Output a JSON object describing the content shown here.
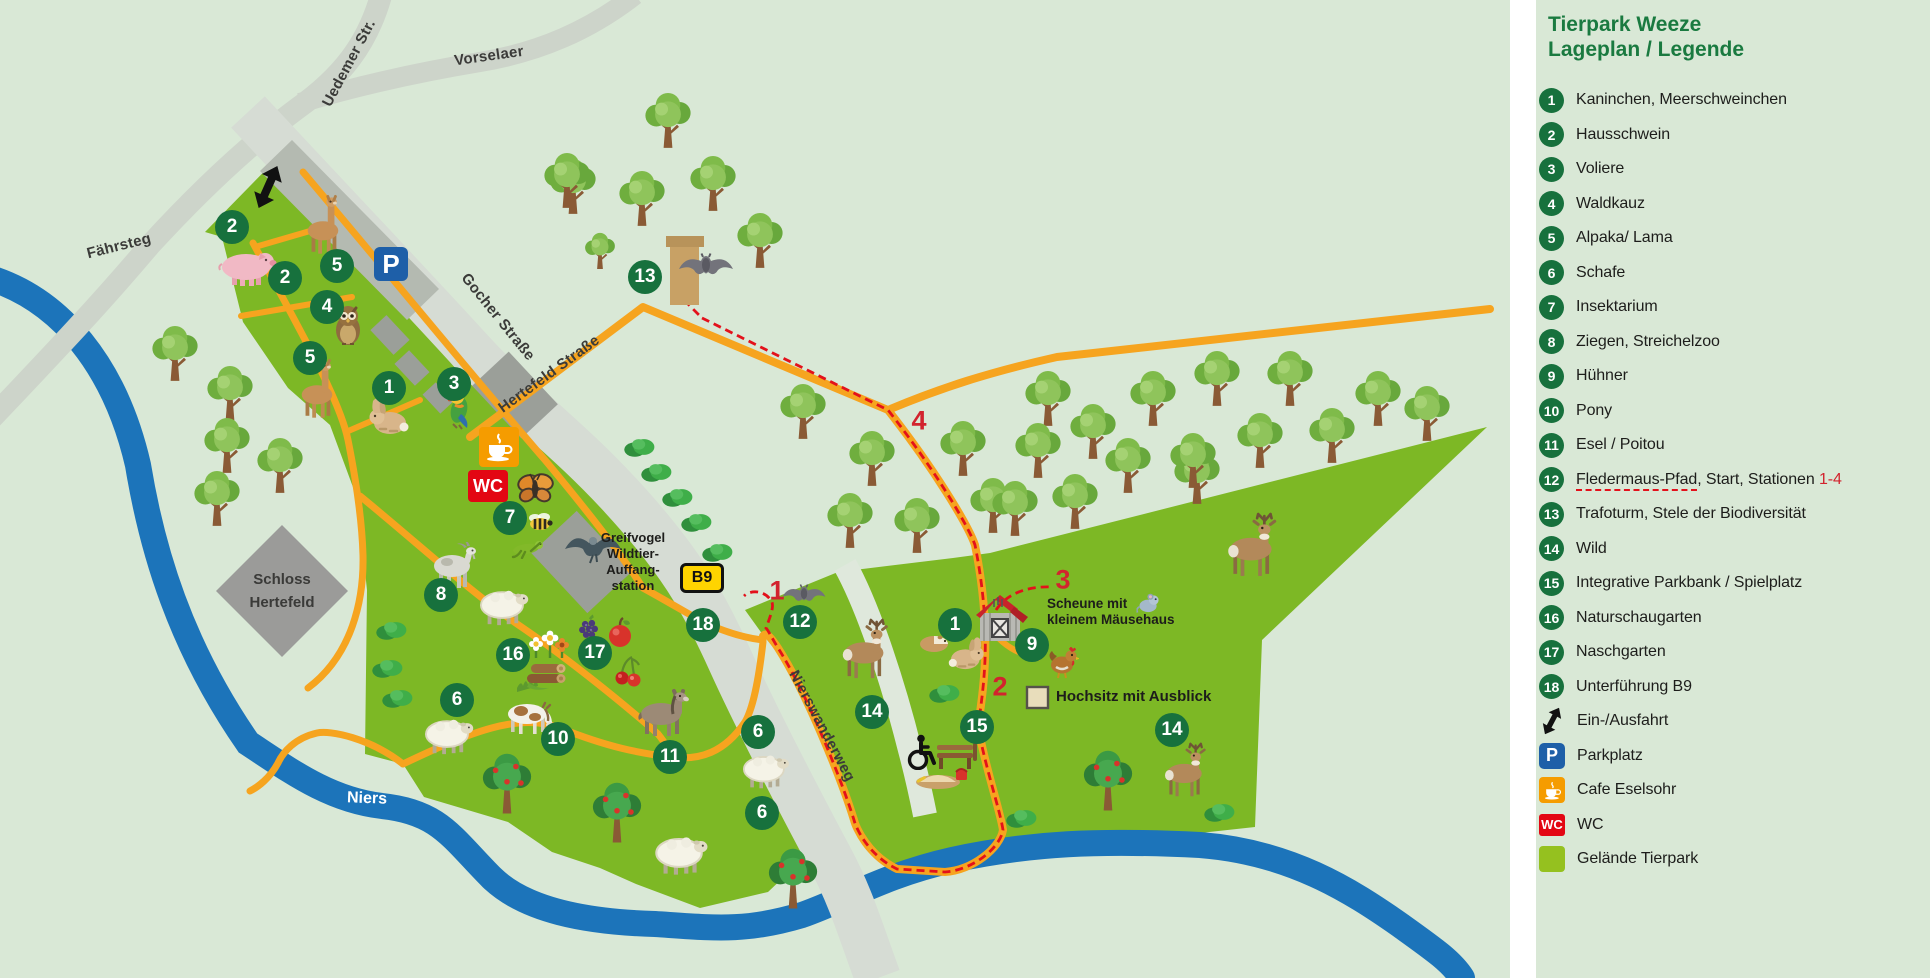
{
  "title": {
    "line1": "Tierpark Weeze",
    "line2": "Lageplan / Legende"
  },
  "legend": {
    "items": [
      {
        "num": "1",
        "label": "Kaninchen, Meerschweinchen"
      },
      {
        "num": "2",
        "label": "Hausschwein"
      },
      {
        "num": "3",
        "label": "Voliere"
      },
      {
        "num": "4",
        "label": "Waldkauz"
      },
      {
        "num": "5",
        "label": "Alpaka/ Lama"
      },
      {
        "num": "6",
        "label": "Schafe"
      },
      {
        "num": "7",
        "label": "Insektarium"
      },
      {
        "num": "8",
        "label": "Ziegen, Streichelzoo"
      },
      {
        "num": "9",
        "label": "Hühner"
      },
      {
        "num": "10",
        "label": "Pony"
      },
      {
        "num": "11",
        "label": "Esel / Poitou"
      },
      {
        "num": "12",
        "label": "Fledermaus-Pfad, Start, Stationen 1-4",
        "parts": {
          "underlined": "Fledermaus-Pfad",
          "middle": ", Start, Stationen ",
          "red": "1-4"
        }
      },
      {
        "num": "13",
        "label": "Trafoturm, Stele der Biodiversität"
      },
      {
        "num": "14",
        "label": "Wild"
      },
      {
        "num": "15",
        "label": "Integrative Parkbank / Spielplatz"
      },
      {
        "num": "16",
        "label": "Naturschaugarten"
      },
      {
        "num": "17",
        "label": "Naschgarten"
      },
      {
        "num": "18",
        "label": "Unterführung B9"
      }
    ],
    "symbols": [
      {
        "icon": "entry-arrow",
        "label": "Ein-/Ausfahrt"
      },
      {
        "icon": "parking",
        "badge": "P",
        "label": "Parkplatz"
      },
      {
        "icon": "cafe",
        "label": "Cafe Eselsohr"
      },
      {
        "icon": "wc",
        "badge": "WC",
        "label": "WC"
      },
      {
        "icon": "area",
        "label": "Gelände Tierpark"
      }
    ]
  },
  "map": {
    "roads": {
      "uedemer": "Uedemer Str.",
      "vorselaer": "Vorselaer",
      "faehrsteg": "Fährsteg",
      "gocher": "Gocher Straße",
      "hertefeld": "Hertefeld Straße",
      "nierswanderweg": "Nierswanderweg",
      "river": "Niers"
    },
    "badges": {
      "b9": "B9",
      "parking": "P",
      "wc": "WC"
    },
    "pois": {
      "schloss_line1": "Schloss",
      "schloss_line2": "Hertefeld",
      "greifvogel_line1": "Greifvogel",
      "greifvogel_line2": "Wildtier-",
      "greifvogel_line3": "Auffang-",
      "greifvogel_line4": "station",
      "scheune_line1": "Scheune mit",
      "scheune_line2": "kleinem Mäusehaus",
      "hochsitz": "Hochsitz mit Ausblick"
    },
    "markers": [
      {
        "n": "1",
        "x": 389,
        "y": 388
      },
      {
        "n": "1",
        "x": 955,
        "y": 625
      },
      {
        "n": "2",
        "x": 232,
        "y": 227
      },
      {
        "n": "2",
        "x": 285,
        "y": 278
      },
      {
        "n": "3",
        "x": 454,
        "y": 384
      },
      {
        "n": "4",
        "x": 327,
        "y": 307
      },
      {
        "n": "5",
        "x": 337,
        "y": 266
      },
      {
        "n": "5",
        "x": 310,
        "y": 358
      },
      {
        "n": "6",
        "x": 457,
        "y": 700
      },
      {
        "n": "6",
        "x": 758,
        "y": 732
      },
      {
        "n": "6",
        "x": 762,
        "y": 813
      },
      {
        "n": "7",
        "x": 510,
        "y": 518
      },
      {
        "n": "8",
        "x": 441,
        "y": 595
      },
      {
        "n": "9",
        "x": 1032,
        "y": 645
      },
      {
        "n": "10",
        "x": 558,
        "y": 739
      },
      {
        "n": "11",
        "x": 670,
        "y": 757
      },
      {
        "n": "12",
        "x": 800,
        "y": 622
      },
      {
        "n": "13",
        "x": 645,
        "y": 277
      },
      {
        "n": "14",
        "x": 872,
        "y": 712
      },
      {
        "n": "14",
        "x": 1172,
        "y": 730
      },
      {
        "n": "15",
        "x": 977,
        "y": 727
      },
      {
        "n": "16",
        "x": 513,
        "y": 655
      },
      {
        "n": "17",
        "x": 595,
        "y": 653
      },
      {
        "n": "18",
        "x": 703,
        "y": 625
      }
    ],
    "stations": [
      {
        "n": "1",
        "x": 777,
        "y": 591
      },
      {
        "n": "2",
        "x": 1000,
        "y": 687
      },
      {
        "n": "3",
        "x": 1063,
        "y": 580
      },
      {
        "n": "4",
        "x": 919,
        "y": 421
      }
    ]
  },
  "colors": {
    "background": "#d9e8d6",
    "park_green": "#7db825",
    "legend_area_green": "#95c11f",
    "road_gray": "#d6dcd4",
    "building_gray": "#9b9f99",
    "path_orange": "#f6a41f",
    "route_red": "#e3111b",
    "river_blue": "#1c74ba",
    "marker_green": "#17713d",
    "title_green": "#1a7a40",
    "parking_blue": "#1e5fa8",
    "wc_red": "#e30613",
    "cafe_orange": "#f59c00",
    "b9_yellow": "#ffd400"
  }
}
